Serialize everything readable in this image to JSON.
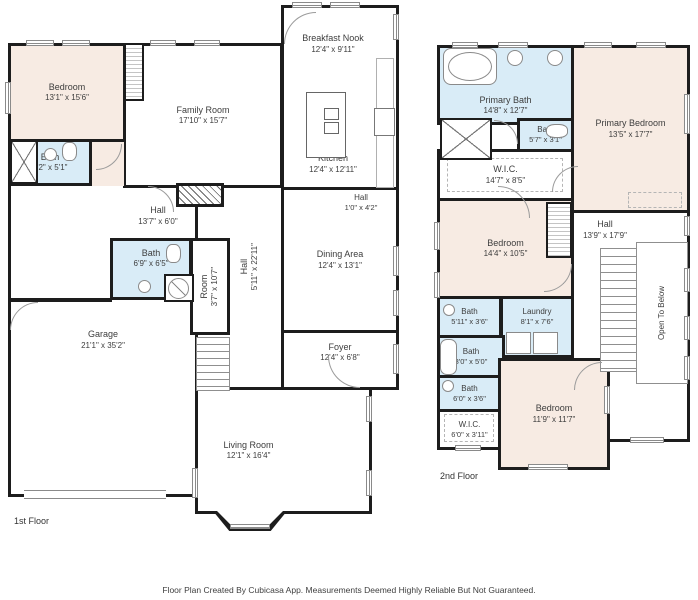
{
  "page": {
    "footer": "Floor Plan Created By Cubicasa App. Measurements Deemed Highly Reliable But Not Guaranteed.",
    "colors": {
      "wall": "#1d1d1d",
      "bedroom_fill": "#f7ebe3",
      "bath_fill": "#d9ecf7",
      "background": "#ffffff",
      "label_text": "#3d3d3d"
    }
  },
  "floor1": {
    "label": "1st Floor",
    "rooms": [
      {
        "name": "Bedroom",
        "dims": "13'1\" x 15'6\""
      },
      {
        "name": "Bath",
        "dims": "9'2\" x 5'1\""
      },
      {
        "name": "Family Room",
        "dims": "17'10\" x 15'7\""
      },
      {
        "name": "Breakfast Nook",
        "dims": "12'4\" x 9'11\""
      },
      {
        "name": "Kitchen",
        "dims": "12'4\" x 12'11\""
      },
      {
        "name": "Hall",
        "dims": "13'7\" x 6'0\""
      },
      {
        "name": "Bath",
        "dims": "6'9\" x 6'5\""
      },
      {
        "name": "Room",
        "dims": "3'7\" x 10'7\""
      },
      {
        "name": "Hall",
        "dims": "5'11\" x 22'11\""
      },
      {
        "name": "Hall",
        "dims": "1'0\" x 4'2\""
      },
      {
        "name": "Dining Area",
        "dims": "12'4\" x 13'1\""
      },
      {
        "name": "Foyer",
        "dims": "12'4\" x 6'8\""
      },
      {
        "name": "Garage",
        "dims": "21'1\" x 35'2\""
      },
      {
        "name": "Living Room",
        "dims": "12'1\" x 16'4\""
      }
    ]
  },
  "floor2": {
    "label": "2nd Floor",
    "open_to_below": "Open To Below",
    "rooms": [
      {
        "name": "Primary Bath",
        "dims": "14'8\" x 12'7\""
      },
      {
        "name": "Bath",
        "dims": "5'7\" x 3'1\""
      },
      {
        "name": "W.I.C.",
        "dims": "14'7\" x 8'5\""
      },
      {
        "name": "Primary Bedroom",
        "dims": "13'5\" x 17'7\""
      },
      {
        "name": "Bedroom",
        "dims": "14'4\" x 10'5\""
      },
      {
        "name": "Hall",
        "dims": "13'9\" x 17'9\""
      },
      {
        "name": "Bath",
        "dims": "5'11\" x 3'6\""
      },
      {
        "name": "Laundry",
        "dims": "8'1\" x 7'6\""
      },
      {
        "name": "Bath",
        "dims": "8'0\" x 5'0\""
      },
      {
        "name": "Bath",
        "dims": "6'0\" x 3'6\""
      },
      {
        "name": "W.I.C.",
        "dims": "6'0\" x 3'11\""
      },
      {
        "name": "Bedroom",
        "dims": "11'9\" x 11'7\""
      }
    ]
  }
}
